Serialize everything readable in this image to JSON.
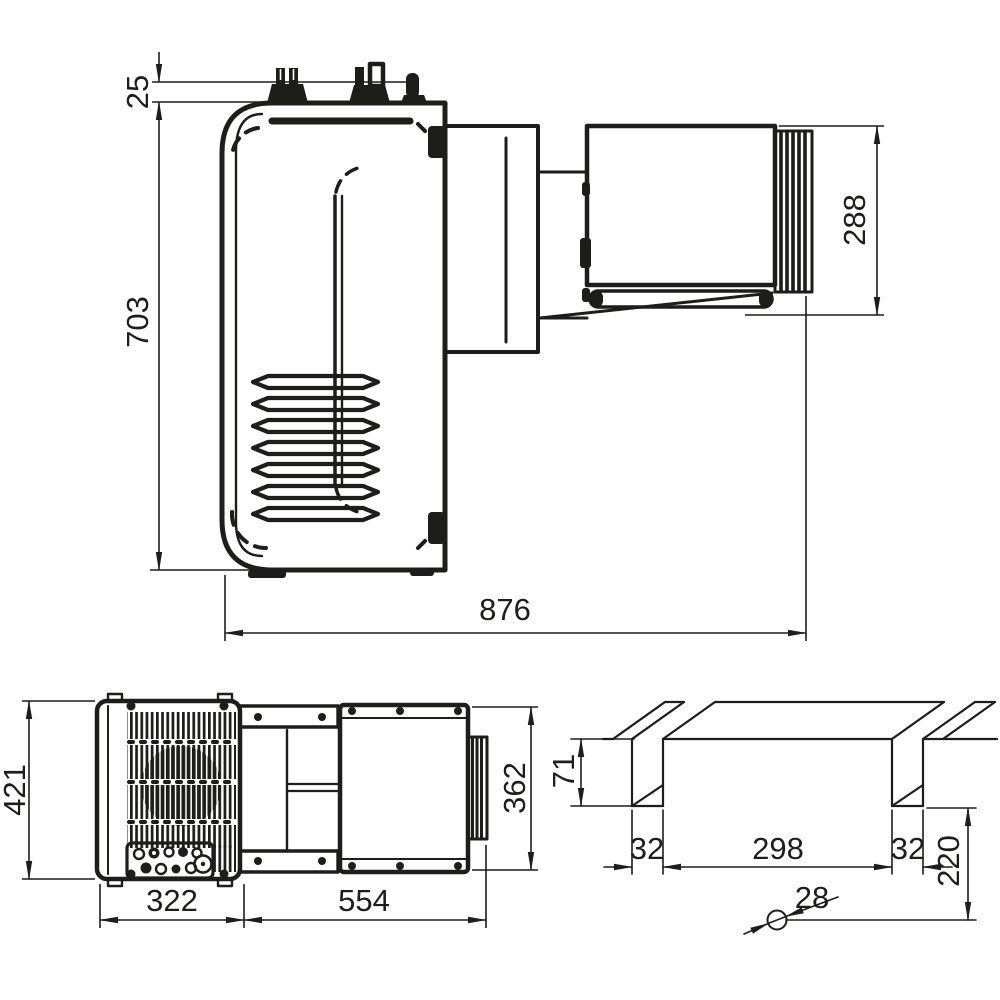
{
  "drawing": {
    "type": "technical-dimension-drawing",
    "background_color": "#ffffff",
    "line_color": "#1d1d1b",
    "views": {
      "side": {
        "name": "side-elevation-view",
        "labels": {
          "d25": "25",
          "d703": "703",
          "d288": "288",
          "d876": "876"
        }
      },
      "plan": {
        "name": "plan-view",
        "labels": {
          "d421": "421",
          "d322": "322",
          "d554": "554",
          "d362": "362"
        }
      },
      "cutout": {
        "name": "wall-cutout-view",
        "labels": {
          "d71": "71",
          "d32_left": "32",
          "d298": "298",
          "d32_right": "32",
          "d220": "220",
          "d28": "28"
        }
      }
    }
  }
}
